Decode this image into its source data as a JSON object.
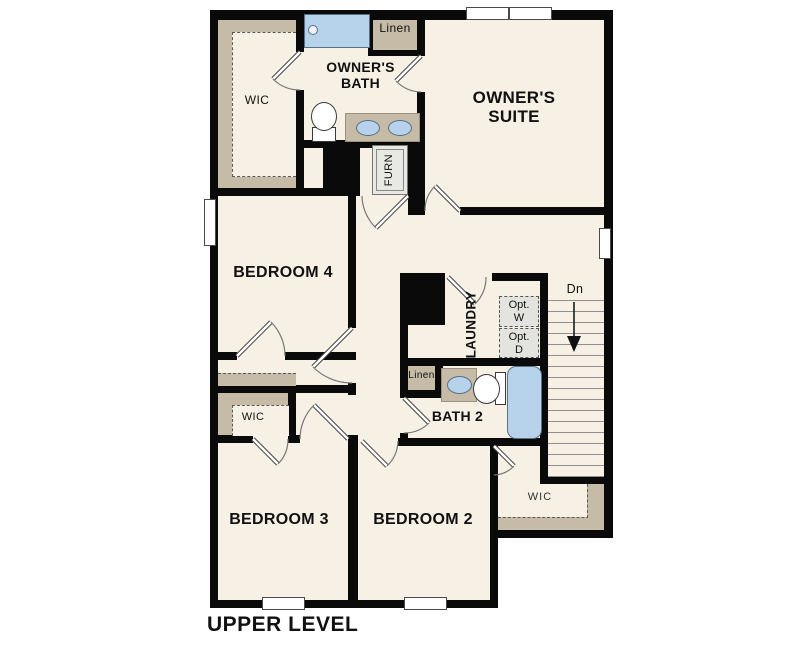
{
  "title": "UPPER LEVEL",
  "colors": {
    "room_fill": "#f7f0e4",
    "wall": "#0a0a0a",
    "shelf_tan": "#c6bba6",
    "fixture_blue": "#b7d3ec",
    "appliance_gray": "#e3e3e0"
  },
  "rooms": {
    "owners_suite": {
      "line1": "OWNER'S",
      "line2": "SUITE"
    },
    "owners_bath": {
      "line1": "OWNER'S",
      "line2": "BATH"
    },
    "bedroom4": {
      "label": "BEDROOM 4"
    },
    "bedroom3": {
      "label": "BEDROOM 3"
    },
    "bedroom2": {
      "label": "BEDROOM 2"
    },
    "bath2": {
      "label": "BATH 2"
    },
    "laundry": {
      "label": "LAUNDRY"
    }
  },
  "closets": {
    "owners_wic": {
      "label": "WIC"
    },
    "bedroom3_wic": {
      "label": "WIC"
    },
    "bedroom2_wic": {
      "label": "WIC"
    },
    "linen_upper": {
      "label": "Linen"
    },
    "linen_bath2": {
      "label": "Linen"
    },
    "furnace": {
      "label": "FURN"
    }
  },
  "laundry_options": {
    "washer": {
      "line1": "Opt.",
      "line2": "W"
    },
    "dryer": {
      "line1": "Opt.",
      "line2": "D"
    }
  },
  "stairs": {
    "direction_label": "Dn"
  }
}
